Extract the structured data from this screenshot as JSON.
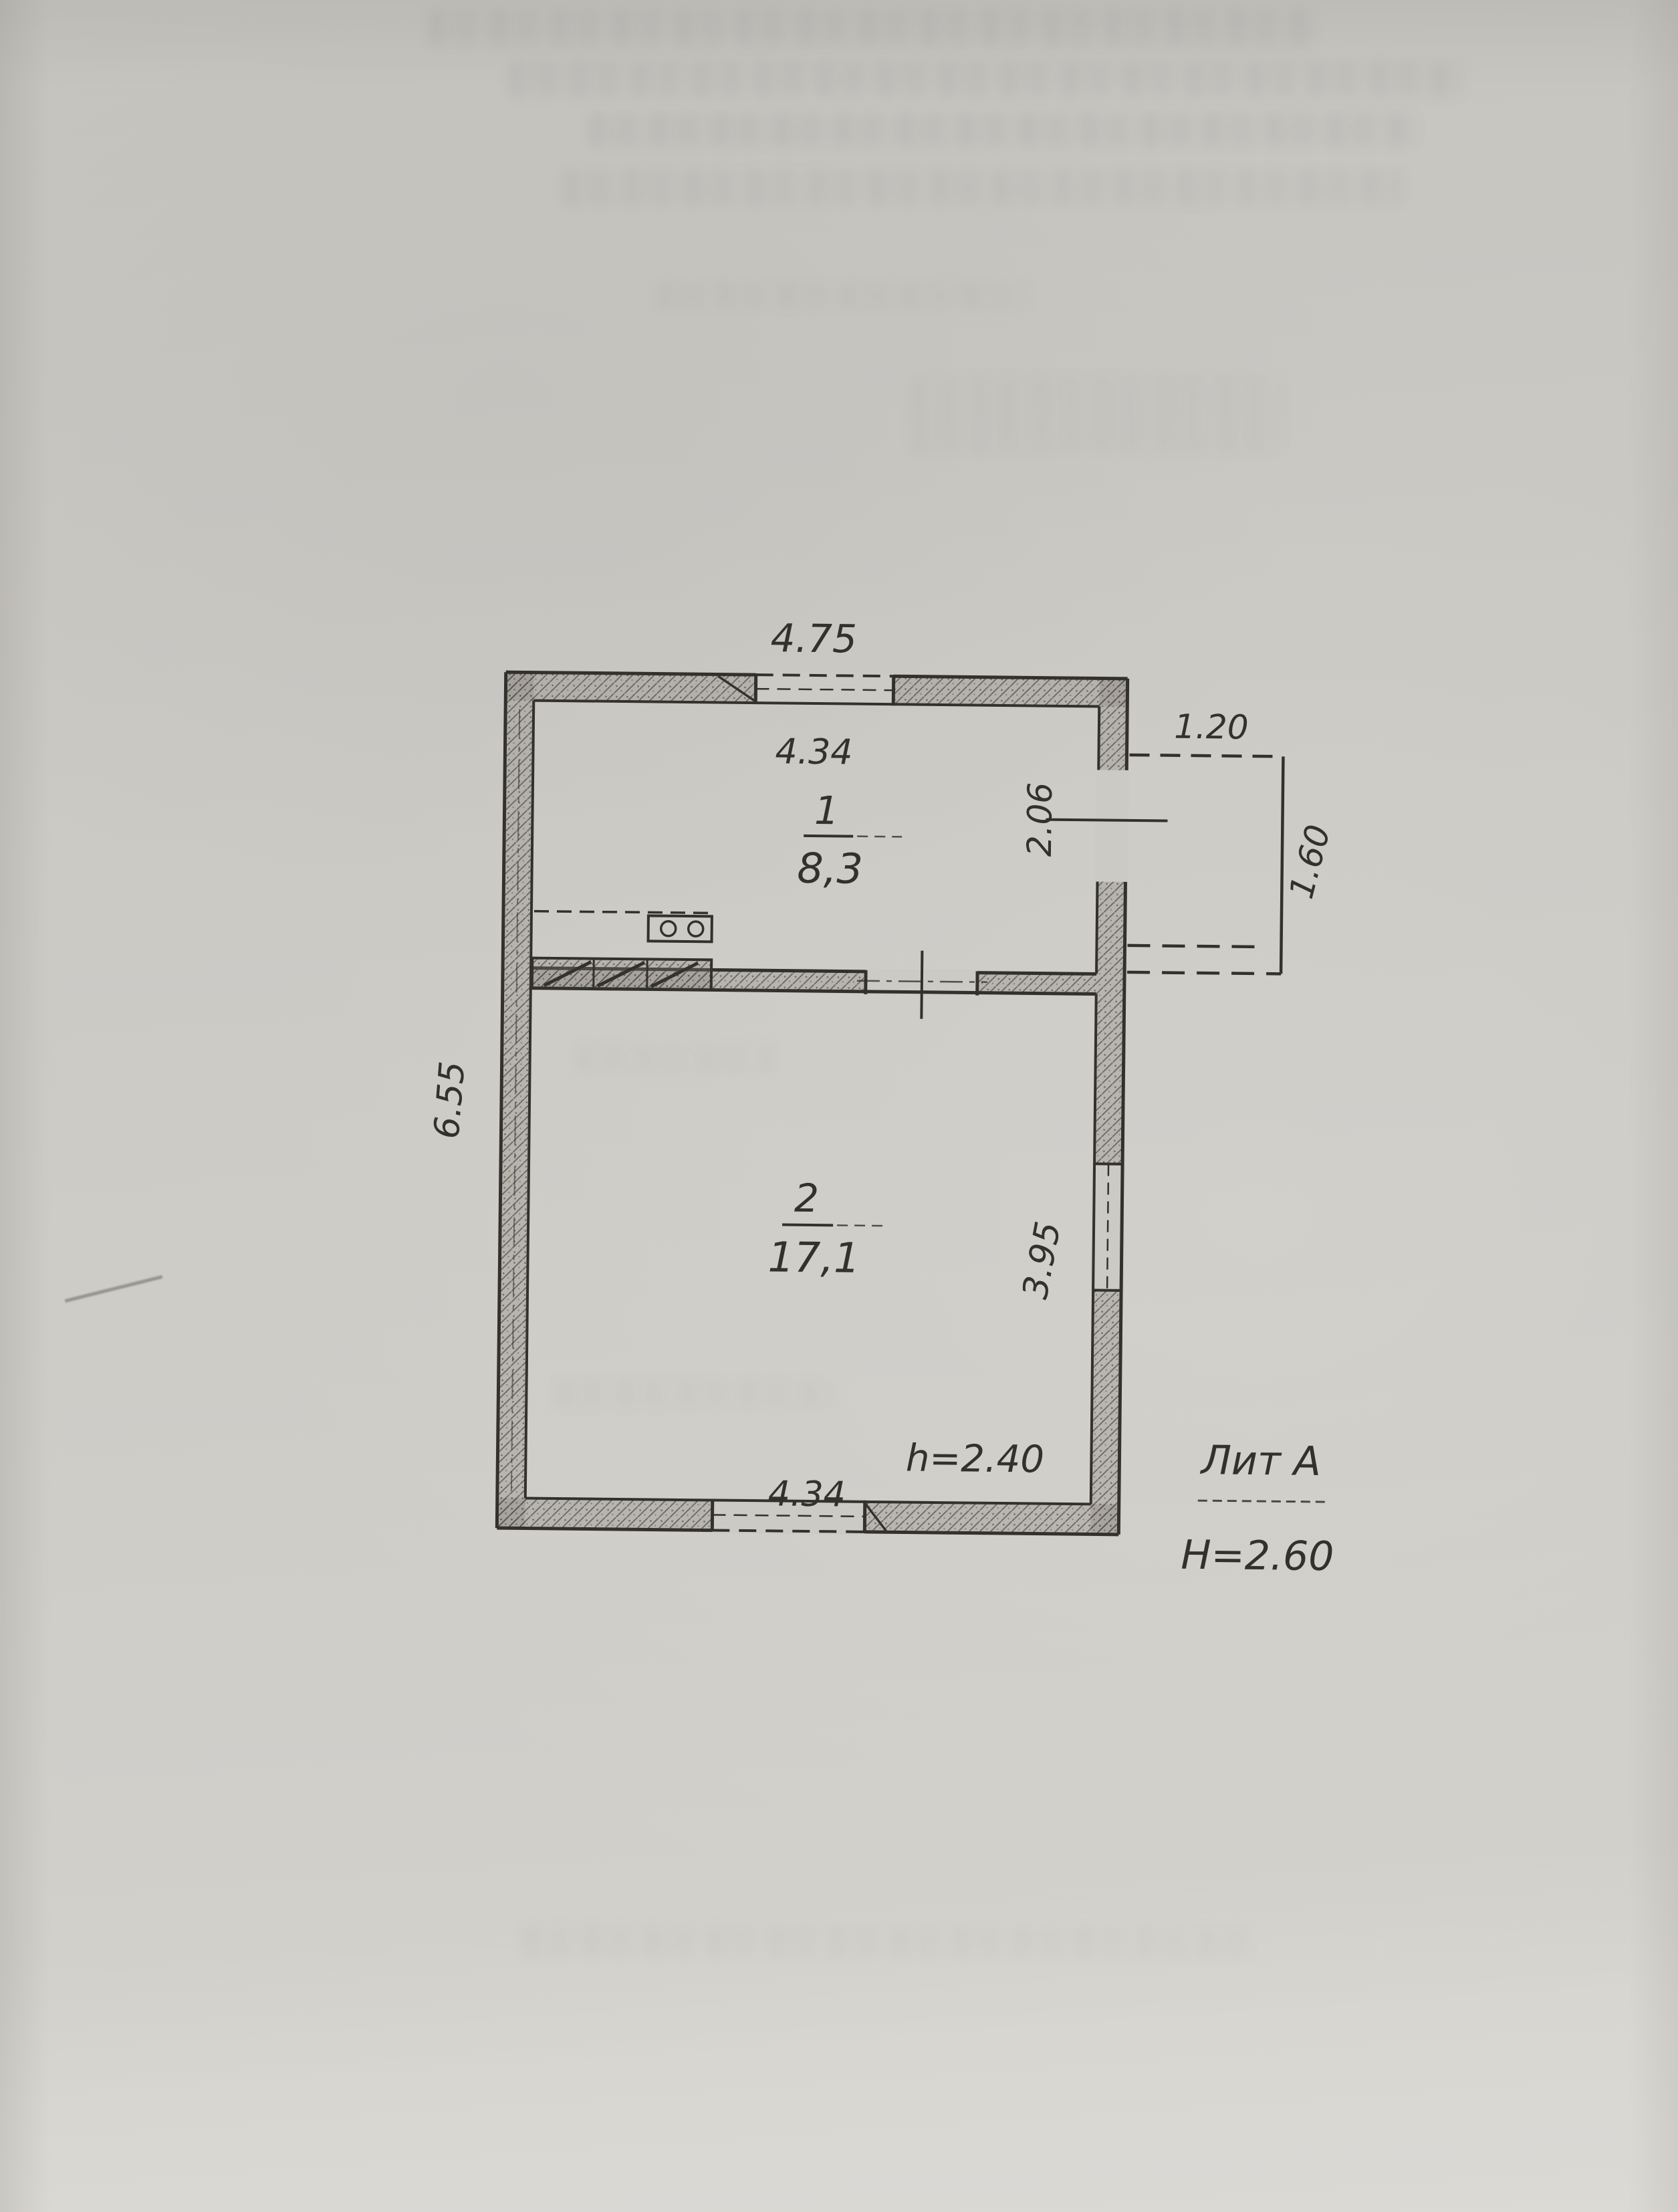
{
  "document": {
    "kind": "scanned floor plan sheet",
    "colors": {
      "paper": "#cccac5",
      "ink": "#33312c",
      "wall_fill": "#8d8981"
    }
  },
  "plan": {
    "rooms": [
      {
        "number": "1",
        "area": "8,3"
      },
      {
        "number": "2",
        "area": "17,1"
      }
    ],
    "dimensions": {
      "top_exterior_width": "4.75",
      "room1_interior_width": "4.34",
      "room1_interior_depth": "2.06",
      "porch_width": "1.20",
      "porch_depth": "1.60",
      "left_exterior_height": "6.55",
      "room2_interior_depth": "3.95",
      "room2_interior_width": "4.34"
    },
    "annotations": {
      "ceiling_height": "h=2.40",
      "litera": "Лит А",
      "building_height": "H=2.60"
    }
  }
}
